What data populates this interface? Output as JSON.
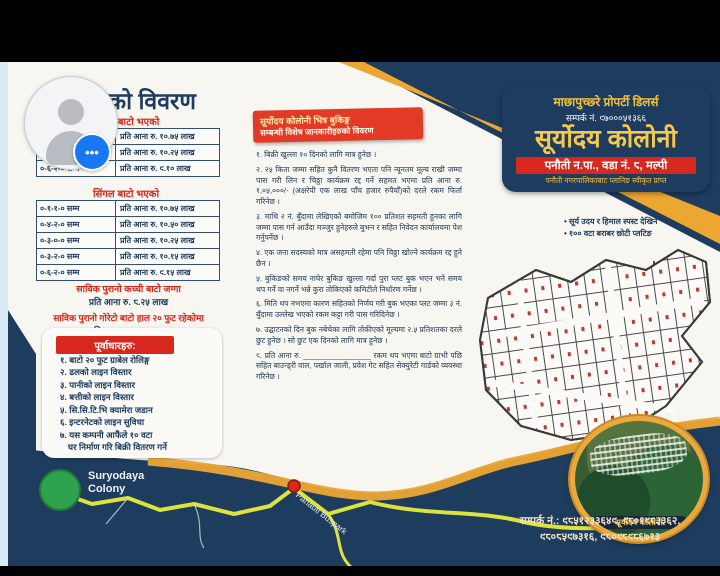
{
  "overlay": {
    "chat_dots": "•••"
  },
  "colors": {
    "navy": "#1d3c5e",
    "red": "#d6281c",
    "orange": "#eca733",
    "chat_blue": "#1877f2",
    "road_yellow": "#dde23d",
    "map_green": "#2ea24e"
  },
  "flyer": {
    "left": {
      "title": "जग्गाको विवरण",
      "section1": {
        "heading": "दोहोरी बाटो भएको",
        "rows": [
          {
            "range": "०-४-०-० सम्म",
            "rate": "प्रति आना रु. १०.७५ लाख"
          },
          {
            "range": "०-५-२-० सम्म",
            "rate": "प्रति आना रु. १०.२५ लाख"
          },
          {
            "range": "०-६-२-० सम्म",
            "rate": "प्रति आना रु. ९.१० लाख"
          }
        ]
      },
      "section2": {
        "heading": "सिंगल बाटो भएको",
        "rows": [
          {
            "range": "०-१-१-० सम्म",
            "rate": "प्रति आना रु. १०.७५ लाख"
          },
          {
            "range": "०-४-२-० सम्म",
            "rate": "प्रति आना रु. १०.५० लाख"
          },
          {
            "range": "०-३-०-० सम्म",
            "rate": "प्रति आना रु. १०.२५ लाख"
          },
          {
            "range": "०-३-२-० सम्म",
            "rate": "प्रति आना रु. १०.१५ लाख"
          },
          {
            "range": "०-६-२-० सम्म",
            "rate": "प्रति आना रु. ९.१५ लाख"
          }
        ]
      },
      "note1": {
        "heading": "साविक पुरानो कच्ची बाटो जग्गा",
        "rate": "प्रति आना रु. ८.२५ लाख"
      },
      "note2": {
        "heading": "साविक पुरानो गोरेटो बाटो हाल २० फुट रहेकोमा",
        "rate": "प्रति आना रु. ८.७५ लाख"
      },
      "infra": {
        "heading": "पूर्वाधारहरु:",
        "items": [
          "१. बाटो २० फुट ग्राबेल रोलिङ्ग",
          "२. ढलको लाइन विस्तार",
          "३. पानीको लाइन विस्तार",
          "४. बत्तीको लाइन विस्तार",
          "५. सि.सि.टि.भि क्यामेरा जडान",
          "६. इन्टरनेटको लाइन सुविधा",
          "७. यस कम्पनी आफैंले १० वटा",
          "घर निर्माण गरि बिक्री वितरण गर्ने"
        ]
      }
    },
    "middle": {
      "header_line1": "सूर्योदय कोलोनी भित्र बुकिङ्ग",
      "header_line2": "सम्बन्धी विशेष जानकारीहरुको विवरण",
      "items": [
        "१. बिक्री खुल्ला १० दिनको लागि मात्र हुनेछ ।",
        "२. २५ किता जम्मा सहित कुनै वितरण भएता पनि न्यूनतम मूल्य राखी जम्मा पास गरी लिन र चिठ्ठा कार्यक्रम रद्द गर्ने सहमत भएमा प्रति आना रु. १,०५,०००/- (अक्षरेपी एक लाख पाँच हजार रुपैयाँ)को दरले रकम फिर्ता गरिनेछ ।",
        "३. माथि २ नं. बुँदामा लेखिएको बमोजिम १०० प्रतिशत सहमती हुनका लागि जम्मा पास गर्न आउँदा मञ्जुर हुनेहरुले बुझ्न र सहित निवेदन कार्यालयमा पेश गर्नुपर्नेछ ।",
        "४. एक जना सदस्यको मात्र असहमती रहेमा पनि चिठ्ठा खोल्ने कार्यक्रम रद्द हुने छैन ।",
        "५. बुकिङको समय नाघेर बुकिङ खुल्ला गर्दा पुरा प्लट बुक भएन भने समय थप गर्ने वा नगर्ने भन्ने कुरा तोकिएको कमिटीले निर्धारण गर्नेछ ।",
        "६. मिति थप नभएमा कारण सहितको निर्णय गरी बुक भएका प्लट जम्मा ३ नं. बुँदामा उल्लेख भएको रकम कट्टा गरी पास गरिदिनेछ ।",
        "७. उद्घाटनको दिन बुक नबेचेका लागि तोकीएको मूल्यमा २.५ प्रतिशतका दरले छुट हुनेछ । सो छुट एक दिनको लागि मात्र हुनेछ ।",
        "८. प्रति आना रु. ________________ रकम थप भएमा बाटो ग्राभी पछि सहित बाउन्ड्री वाल, पर्खाल जाली, प्रवेश गेट सहित सेक्युरेटी गार्डको व्यवस्था गरिनेछ ।"
      ]
    },
    "right": {
      "dealer": "माछापुच्छ्रे प्रोपर्टी डिलर्स",
      "contact_top": "सम्पर्क नं. ९७०००५१३६६",
      "brand": "सूर्योदय कोलोनी",
      "address": "पनौती न.पा., वडा नं. ८, मल्पी",
      "approval": "पनौती नगरपालिकाबाट प्लानिङ स्वीकृत प्राप्त",
      "bullets": [
        "• सूर्य उदय र हिमाल स्पस्ट देखिने",
        "• १०० वटा बराबर छोटी प्लटिङ"
      ],
      "compass_label": "N",
      "photo_caption": "सूर्योदय कोलोनी",
      "contact_bottom_line1": "सम्पर्क नं.: ९८५१२३३६४९, ९८०१९८३३६२,",
      "contact_bottom_line2": "९८०८५९७३१६, ९८०९८९८६७१३"
    },
    "map": {
      "colony_label": "Suryodaya Colony",
      "buspark_label": "Panauti Buspark"
    }
  }
}
